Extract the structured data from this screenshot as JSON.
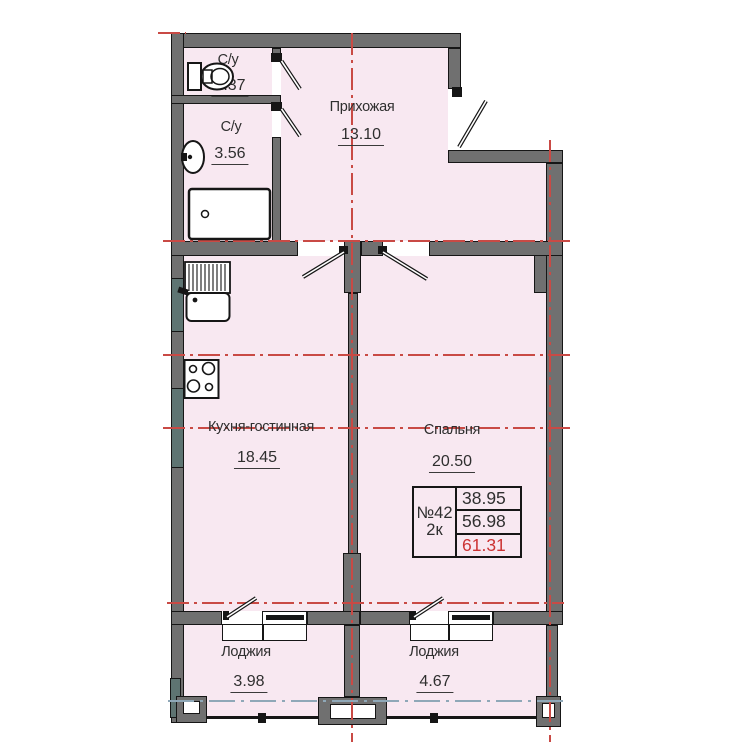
{
  "rooms": [
    {
      "name": "С/у",
      "area": "1.37"
    },
    {
      "name": "С/у",
      "area": "3.56"
    },
    {
      "name": "Прихожая",
      "area": "13.10"
    },
    {
      "name": "Кухня-гостинная",
      "area": "18.45"
    },
    {
      "name": "Спальня",
      "area": "20.50"
    },
    {
      "name": "Лоджия",
      "area": "3.98"
    },
    {
      "name": "Лоджия",
      "area": "4.67"
    }
  ],
  "info_box": {
    "number": "№42",
    "type": "2к",
    "area_living": "38.95",
    "area_main": "56.98",
    "area_total": "61.31"
  },
  "colors": {
    "room_fill": "#f8e8f1",
    "wall_fill": "#707070",
    "wall_alt_fill": "#5e7472",
    "axis_red": "#c94a45",
    "axis_blue": "#8fa8b8",
    "total_red": "#cc3333"
  }
}
